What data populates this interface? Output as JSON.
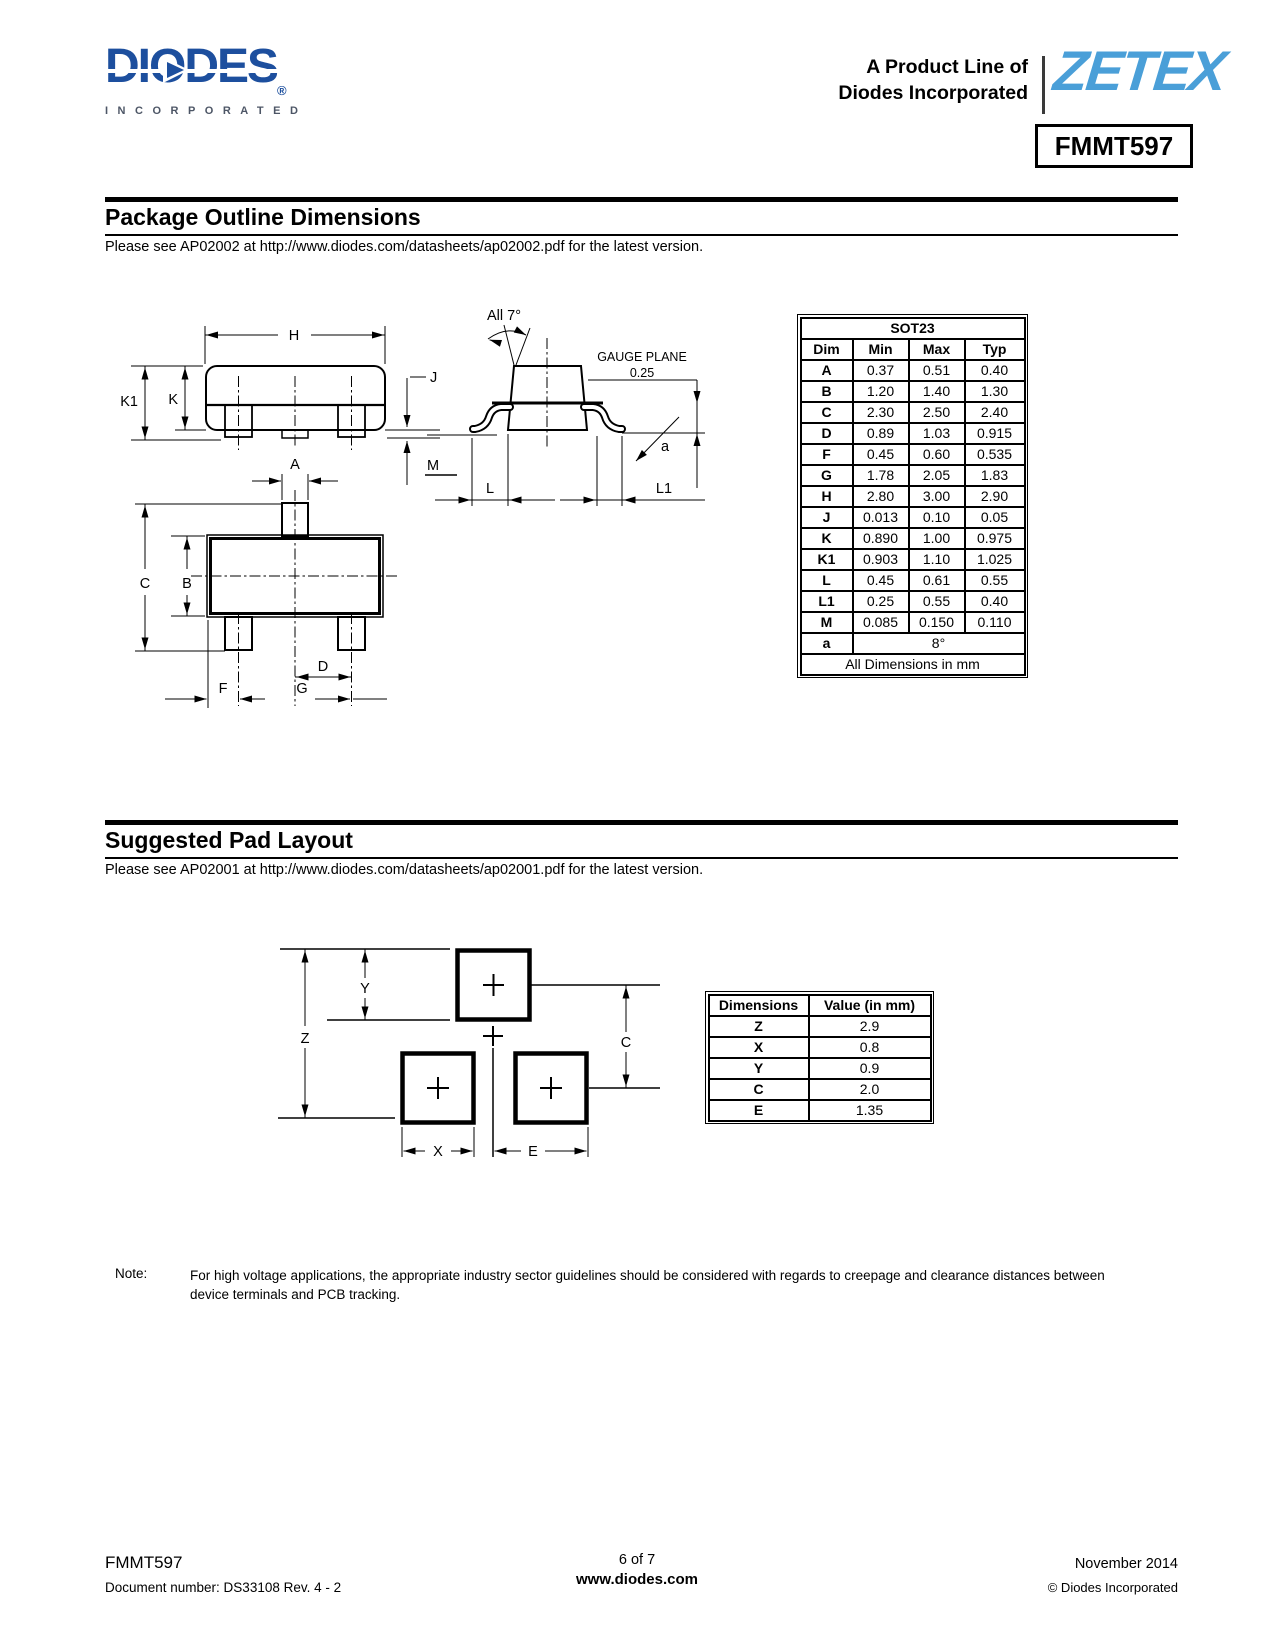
{
  "colors": {
    "diodes_blue": "#1d4f9e",
    "zetex_blue": "#4a9fd8"
  },
  "header": {
    "logo_text": "DIODES",
    "logo_reg": "®",
    "logo_sub": "INCORPORATED",
    "product_line_1": "A Product Line of",
    "product_line_2": "Diodes Incorporated",
    "brand": "ZETEX",
    "part_number": "FMMT597"
  },
  "package_outline": {
    "title": "Package Outline Dimensions",
    "subtitle": "Please see AP02002 at http://www.diodes.com/datasheets/ap02002.pdf for the latest version.",
    "labels": {
      "H": "H",
      "K1": "K1",
      "K": "K",
      "J": "J",
      "M": "M",
      "A": "A",
      "C": "C",
      "B": "B",
      "D": "D",
      "F": "F",
      "G": "G",
      "all7": "All 7°",
      "gauge_plane": "GAUGE PLANE",
      "gauge_value": "0.25",
      "a": "a",
      "L": "L",
      "L1": "L1"
    },
    "table": {
      "title": "SOT23",
      "columns": [
        "Dim",
        "Min",
        "Max",
        "Typ"
      ],
      "rows": [
        [
          "A",
          "0.37",
          "0.51",
          "0.40"
        ],
        [
          "B",
          "1.20",
          "1.40",
          "1.30"
        ],
        [
          "C",
          "2.30",
          "2.50",
          "2.40"
        ],
        [
          "D",
          "0.89",
          "1.03",
          "0.915"
        ],
        [
          "F",
          "0.45",
          "0.60",
          "0.535"
        ],
        [
          "G",
          "1.78",
          "2.05",
          "1.83"
        ],
        [
          "H",
          "2.80",
          "3.00",
          "2.90"
        ],
        [
          "J",
          "0.013",
          "0.10",
          "0.05"
        ],
        [
          "K",
          "0.890",
          "1.00",
          "0.975"
        ],
        [
          "K1",
          "0.903",
          "1.10",
          "1.025"
        ],
        [
          "L",
          "0.45",
          "0.61",
          "0.55"
        ],
        [
          "L1",
          "0.25",
          "0.55",
          "0.40"
        ],
        [
          "M",
          "0.085",
          "0.150",
          "0.110"
        ]
      ],
      "angle_row": {
        "dim": "a",
        "value": "8°"
      },
      "footer": "All Dimensions in mm"
    }
  },
  "pad_layout": {
    "title": "Suggested Pad Layout",
    "subtitle": "Please see AP02001 at http://www.diodes.com/datasheets/ap02001.pdf for the latest version.",
    "labels": {
      "Z": "Z",
      "Y": "Y",
      "C": "C",
      "X": "X",
      "E": "E"
    },
    "table": {
      "columns": [
        "Dimensions",
        "Value (in mm)"
      ],
      "rows": [
        [
          "Z",
          "2.9"
        ],
        [
          "X",
          "0.8"
        ],
        [
          "Y",
          "0.9"
        ],
        [
          "C",
          "2.0"
        ],
        [
          "E",
          "1.35"
        ]
      ]
    }
  },
  "note": {
    "label": "Note:",
    "text": "For high voltage applications, the appropriate industry sector guidelines should be considered with regards to creepage and clearance distances between device terminals and PCB tracking."
  },
  "footer": {
    "part": "FMMT597",
    "doc": "Document number: DS33108 Rev. 4 - 2",
    "page": "6 of 7",
    "site": "www.diodes.com",
    "date": "November 2014",
    "copyright": "© Diodes Incorporated"
  }
}
